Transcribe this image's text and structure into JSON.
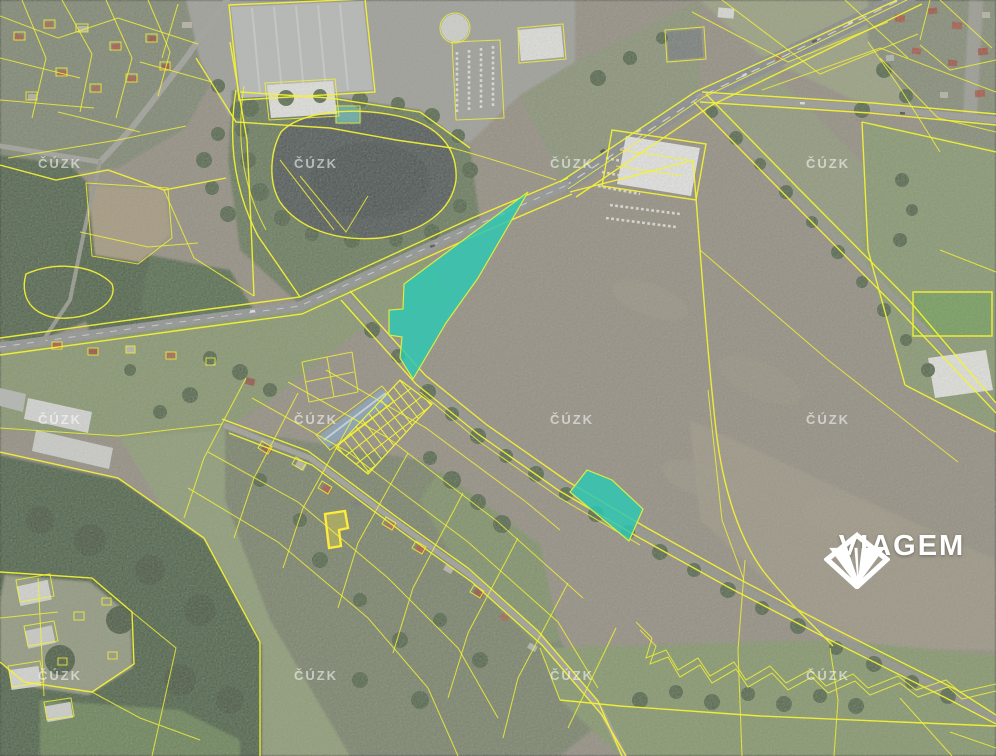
{
  "map": {
    "provider_watermark": "ČÚZK",
    "watermark_positions": [
      {
        "x": 60,
        "y": 168
      },
      {
        "x": 316,
        "y": 168
      },
      {
        "x": 572,
        "y": 168
      },
      {
        "x": 828,
        "y": 168
      },
      {
        "x": 60,
        "y": 424
      },
      {
        "x": 316,
        "y": 424
      },
      {
        "x": 572,
        "y": 424
      },
      {
        "x": 828,
        "y": 424
      },
      {
        "x": 60,
        "y": 680
      },
      {
        "x": 316,
        "y": 680
      },
      {
        "x": 572,
        "y": 680
      },
      {
        "x": 828,
        "y": 680
      }
    ],
    "colors": {
      "cadastral_line": "#f4f235",
      "highlight_fill": "#2fc7b3",
      "highlight_edge": "#d9ed3e",
      "water": "#3f4a48",
      "field": "#8d8779",
      "forest": "#3e5537",
      "road": "#8a8e8d"
    },
    "highlighted_parcels": [
      {
        "id": "highlight-parcel-large",
        "points": [
          [
            528,
            192
          ],
          [
            478,
            278
          ],
          [
            446,
            323
          ],
          [
            413,
            379
          ],
          [
            400,
            358
          ],
          [
            402,
            337
          ],
          [
            389,
            335
          ],
          [
            389,
            310
          ],
          [
            403,
            309
          ],
          [
            404,
            284
          ]
        ]
      },
      {
        "id": "highlight-parcel-small",
        "points": [
          [
            570,
            492
          ],
          [
            587,
            470
          ],
          [
            612,
            480
          ],
          [
            643,
            509
          ],
          [
            629,
            541
          ]
        ]
      }
    ]
  },
  "logo": {
    "text": "VIAGEM",
    "icon": "viagem-gem-icon",
    "color": "#ffffff"
  }
}
